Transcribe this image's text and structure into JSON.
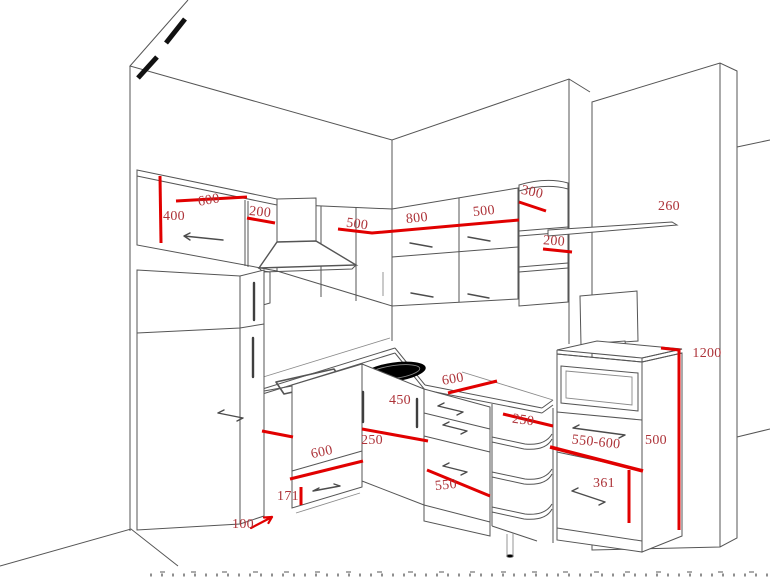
{
  "drawing": {
    "title": "kitchen-perspective-dimension-drawing",
    "colors": {
      "background": "#ffffff",
      "outline": "#555555",
      "dimension_line": "#e10000",
      "dimension_text": "#ad3339",
      "accent_mark": "#111111"
    },
    "dimension_labels": [
      {
        "id": "wall-cabinet-height-400",
        "label": "400",
        "x": 174,
        "y": 217,
        "rot": 0
      },
      {
        "id": "wall-cabinet-width-600",
        "label": "600",
        "x": 209,
        "y": 201,
        "rot": -10
      },
      {
        "id": "wall-cabinet-width-200",
        "label": "200",
        "x": 260,
        "y": 213,
        "rot": 6
      },
      {
        "id": "hood-cabinet-width-500",
        "label": "500",
        "x": 357,
        "y": 225,
        "rot": 8
      },
      {
        "id": "back-cabinet-width-800",
        "label": "800",
        "x": 417,
        "y": 219,
        "rot": -6
      },
      {
        "id": "back-cabinet-width-500",
        "label": "500",
        "x": 484,
        "y": 212,
        "rot": -6
      },
      {
        "id": "corner-shelf-width-300",
        "label": "300",
        "x": 532,
        "y": 193,
        "rot": 12
      },
      {
        "id": "corner-shelf-width-200",
        "label": "200",
        "x": 554,
        "y": 242,
        "rot": 4
      },
      {
        "id": "wall-shelf-length-260",
        "label": "260",
        "x": 669,
        "y": 207,
        "rot": 0
      },
      {
        "id": "tall-unit-height-1200",
        "label": "1200",
        "x": 707,
        "y": 354,
        "rot": 0
      },
      {
        "id": "counter-length-600",
        "label": "600",
        "x": 453,
        "y": 380,
        "rot": -10
      },
      {
        "id": "drawer-height-450",
        "label": "450",
        "x": 400,
        "y": 401,
        "rot": 0
      },
      {
        "id": "base-depth-250",
        "label": "250",
        "x": 372,
        "y": 441,
        "rot": 0
      },
      {
        "id": "dishwasher-width-600",
        "label": "600",
        "x": 322,
        "y": 453,
        "rot": -12
      },
      {
        "id": "drawer-height-171",
        "label": "171",
        "x": 288,
        "y": 497,
        "rot": 0
      },
      {
        "id": "plinth-depth-100",
        "label": "100",
        "x": 243,
        "y": 525,
        "rot": 0
      },
      {
        "id": "counter-width-550",
        "label": "550",
        "x": 446,
        "y": 486,
        "rot": -6
      },
      {
        "id": "corner-base-depth-250",
        "label": "250",
        "x": 523,
        "y": 421,
        "rot": 8
      },
      {
        "id": "tall-unit-depth-550-600",
        "label": "550-600",
        "x": 596,
        "y": 443,
        "rot": 6
      },
      {
        "id": "tall-unit-width-500",
        "label": "500",
        "x": 656,
        "y": 441,
        "rot": 0
      },
      {
        "id": "drawer-height-361",
        "label": "361",
        "x": 604,
        "y": 484,
        "rot": 0
      }
    ]
  }
}
